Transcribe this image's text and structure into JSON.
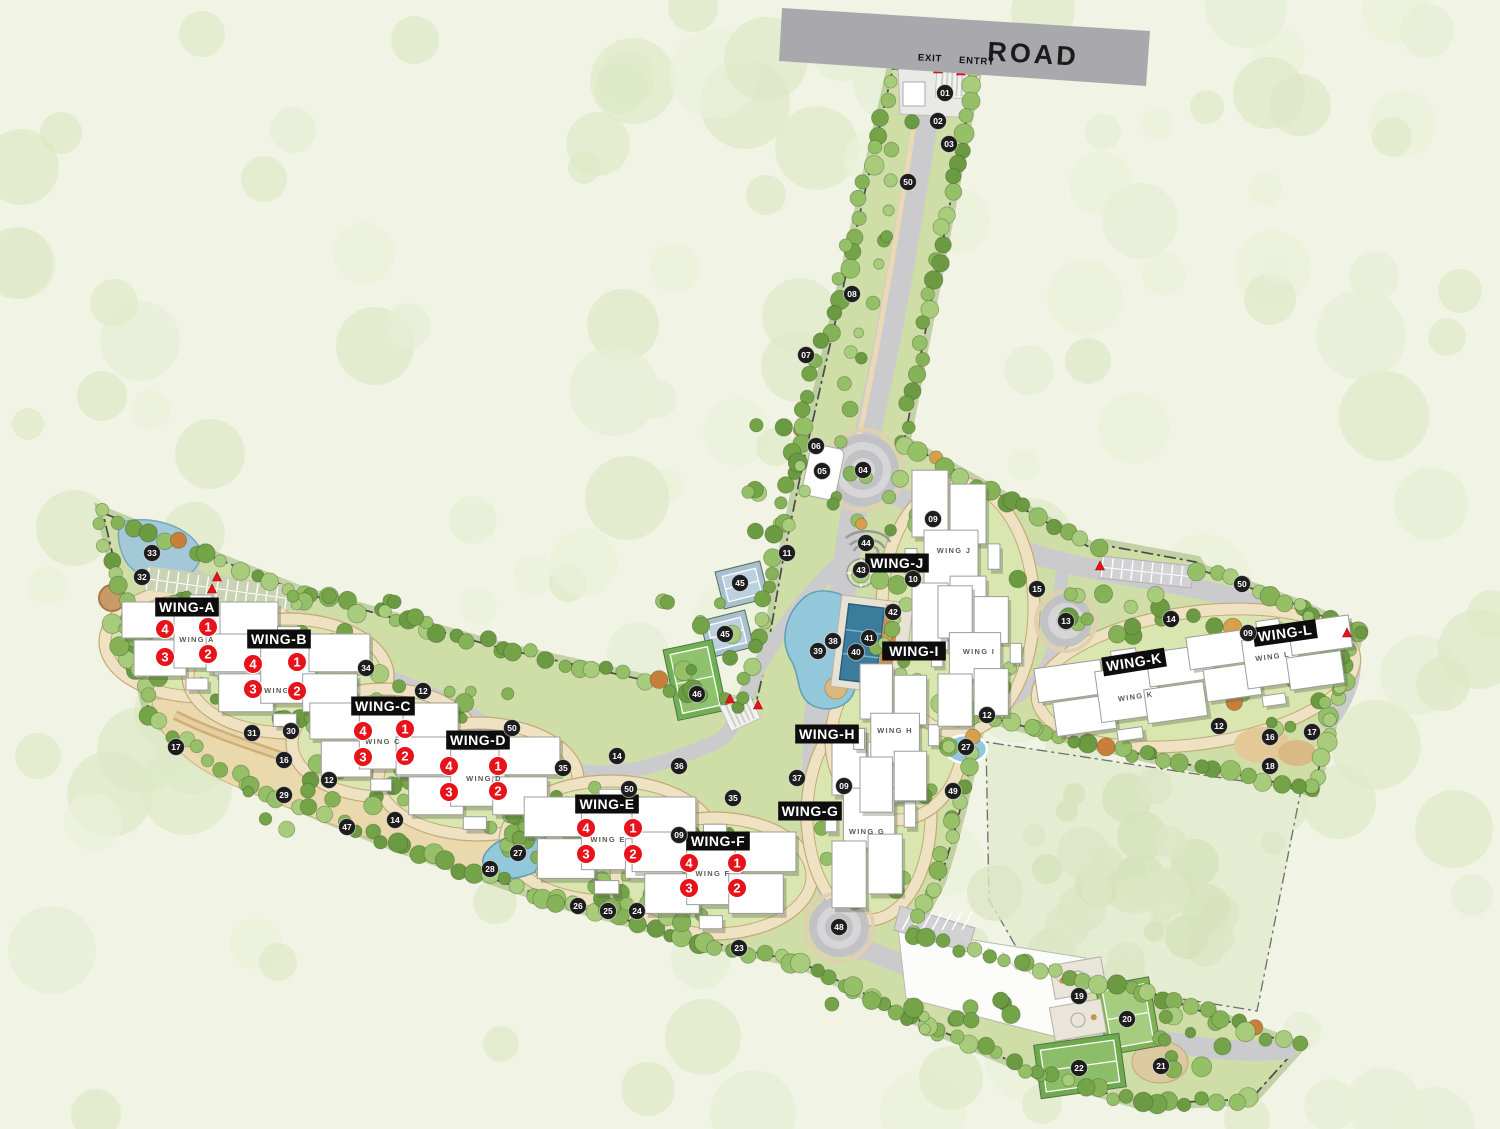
{
  "road": {
    "label": "ROAD",
    "exit": "EXIT",
    "entry": "ENTRY"
  },
  "colors": {
    "chip_bg": "#0d0d0d",
    "chip_text": "#ffffff",
    "unit_badge": "#e8121a",
    "marker_bg": "#1d1d1d",
    "road_banner": "#a9a9ad",
    "water": "#93c7da",
    "site_green": "#cfdda6"
  },
  "wings": [
    {
      "id": "A",
      "chip": "WING-A",
      "cx": 187,
      "cy": 607,
      "rot": 0,
      "bname": "WING A",
      "bx": 197,
      "by": 642,
      "brot": 0,
      "units": [
        {
          "n": "4",
          "x": 165,
          "y": 629
        },
        {
          "n": "1",
          "x": 208,
          "y": 627
        },
        {
          "n": "3",
          "x": 165,
          "y": 657
        },
        {
          "n": "2",
          "x": 208,
          "y": 654
        }
      ]
    },
    {
      "id": "B",
      "chip": "WING-B",
      "cx": 279,
      "cy": 639,
      "rot": 0,
      "bname": "WING B",
      "bx": 282,
      "by": 693,
      "brot": 0,
      "units": [
        {
          "n": "4",
          "x": 253,
          "y": 664
        },
        {
          "n": "1",
          "x": 297,
          "y": 662
        },
        {
          "n": "3",
          "x": 253,
          "y": 689
        },
        {
          "n": "2",
          "x": 297,
          "y": 691
        }
      ]
    },
    {
      "id": "C",
      "chip": "WING-C",
      "cx": 383,
      "cy": 706,
      "rot": 0,
      "bname": "WING C",
      "bx": 383,
      "by": 744,
      "brot": 0,
      "units": [
        {
          "n": "4",
          "x": 363,
          "y": 731
        },
        {
          "n": "1",
          "x": 405,
          "y": 729
        },
        {
          "n": "3",
          "x": 363,
          "y": 757
        },
        {
          "n": "2",
          "x": 405,
          "y": 756
        }
      ]
    },
    {
      "id": "D",
      "chip": "WING-D",
      "cx": 478,
      "cy": 740,
      "rot": 0,
      "bname": "WING D",
      "bx": 484,
      "by": 781,
      "brot": 0,
      "units": [
        {
          "n": "4",
          "x": 449,
          "y": 766
        },
        {
          "n": "1",
          "x": 498,
          "y": 766
        },
        {
          "n": "3",
          "x": 449,
          "y": 792
        },
        {
          "n": "2",
          "x": 498,
          "y": 791
        }
      ]
    },
    {
      "id": "E",
      "chip": "WING-E",
      "cx": 607,
      "cy": 804,
      "rot": 0,
      "bname": "WING E",
      "bx": 608,
      "by": 842,
      "brot": 0,
      "units": [
        {
          "n": "4",
          "x": 586,
          "y": 828
        },
        {
          "n": "1",
          "x": 633,
          "y": 828
        },
        {
          "n": "3",
          "x": 586,
          "y": 854
        },
        {
          "n": "2",
          "x": 633,
          "y": 854
        }
      ]
    },
    {
      "id": "F",
      "chip": "WING-F",
      "cx": 718,
      "cy": 841,
      "rot": 0,
      "bname": "WING F",
      "bx": 713,
      "by": 876,
      "brot": 0,
      "units": [
        {
          "n": "4",
          "x": 689,
          "y": 863
        },
        {
          "n": "1",
          "x": 737,
          "y": 863
        },
        {
          "n": "3",
          "x": 689,
          "y": 888
        },
        {
          "n": "2",
          "x": 737,
          "y": 888
        }
      ]
    },
    {
      "id": "G",
      "chip": "WING-G",
      "cx": 810,
      "cy": 811,
      "rot": 0,
      "bname": "WING G",
      "bx": 867,
      "by": 834,
      "brot": 0,
      "units": []
    },
    {
      "id": "H",
      "chip": "WING-H",
      "cx": 827,
      "cy": 734,
      "rot": 0,
      "bname": "WING H",
      "bx": 895,
      "by": 733,
      "brot": 0,
      "units": []
    },
    {
      "id": "I",
      "chip": "WING-I",
      "cx": 914,
      "cy": 651,
      "rot": 0,
      "bname": "WING I",
      "bx": 979,
      "by": 654,
      "brot": 0,
      "units": []
    },
    {
      "id": "J",
      "chip": "WING-J",
      "cx": 897,
      "cy": 563,
      "rot": 0,
      "bname": "WING J",
      "bx": 954,
      "by": 553,
      "brot": 0,
      "units": []
    },
    {
      "id": "K",
      "chip": "WING-K",
      "cx": 1134,
      "cy": 662,
      "rot": -9,
      "bname": "WING K",
      "bx": 1136,
      "by": 699,
      "brot": -8,
      "units": []
    },
    {
      "id": "L",
      "chip": "WING-L",
      "cx": 1285,
      "cy": 633,
      "rot": -8,
      "bname": "WING L",
      "bx": 1273,
      "by": 659,
      "brot": -8,
      "units": []
    }
  ],
  "markers": [
    {
      "n": "01",
      "x": 945,
      "y": 93
    },
    {
      "n": "02",
      "x": 938,
      "y": 121
    },
    {
      "n": "03",
      "x": 949,
      "y": 144
    },
    {
      "n": "50",
      "x": 908,
      "y": 182
    },
    {
      "n": "08",
      "x": 852,
      "y": 294
    },
    {
      "n": "07",
      "x": 806,
      "y": 355
    },
    {
      "n": "06",
      "x": 816,
      "y": 446
    },
    {
      "n": "05",
      "x": 822,
      "y": 471
    },
    {
      "n": "04",
      "x": 863,
      "y": 470
    },
    {
      "n": "11",
      "x": 787,
      "y": 553
    },
    {
      "n": "44",
      "x": 866,
      "y": 543
    },
    {
      "n": "43",
      "x": 861,
      "y": 570
    },
    {
      "n": "10",
      "x": 913,
      "y": 579
    },
    {
      "n": "09",
      "x": 933,
      "y": 519
    },
    {
      "n": "42",
      "x": 893,
      "y": 612
    },
    {
      "n": "41",
      "x": 869,
      "y": 638
    },
    {
      "n": "40",
      "x": 856,
      "y": 652
    },
    {
      "n": "38",
      "x": 833,
      "y": 641
    },
    {
      "n": "39",
      "x": 818,
      "y": 651
    },
    {
      "n": "45",
      "x": 740,
      "y": 583
    },
    {
      "n": "45",
      "x": 725,
      "y": 634
    },
    {
      "n": "46",
      "x": 697,
      "y": 694
    },
    {
      "n": "36",
      "x": 679,
      "y": 766
    },
    {
      "n": "35",
      "x": 733,
      "y": 798
    },
    {
      "n": "37",
      "x": 797,
      "y": 778
    },
    {
      "n": "09",
      "x": 844,
      "y": 786
    },
    {
      "n": "49",
      "x": 953,
      "y": 791
    },
    {
      "n": "27",
      "x": 966,
      "y": 747
    },
    {
      "n": "12",
      "x": 987,
      "y": 715
    },
    {
      "n": "48",
      "x": 839,
      "y": 927
    },
    {
      "n": "15",
      "x": 1037,
      "y": 589
    },
    {
      "n": "13",
      "x": 1066,
      "y": 621
    },
    {
      "n": "50",
      "x": 1242,
      "y": 584
    },
    {
      "n": "14",
      "x": 1171,
      "y": 619
    },
    {
      "n": "09",
      "x": 1248,
      "y": 633
    },
    {
      "n": "12",
      "x": 1219,
      "y": 726
    },
    {
      "n": "16",
      "x": 1270,
      "y": 737
    },
    {
      "n": "17",
      "x": 1312,
      "y": 732
    },
    {
      "n": "18",
      "x": 1270,
      "y": 766
    },
    {
      "n": "33",
      "x": 152,
      "y": 553
    },
    {
      "n": "32",
      "x": 142,
      "y": 577
    },
    {
      "n": "34",
      "x": 366,
      "y": 668
    },
    {
      "n": "12",
      "x": 423,
      "y": 691
    },
    {
      "n": "31",
      "x": 252,
      "y": 733
    },
    {
      "n": "30",
      "x": 291,
      "y": 731
    },
    {
      "n": "17",
      "x": 176,
      "y": 747
    },
    {
      "n": "16",
      "x": 284,
      "y": 760
    },
    {
      "n": "12",
      "x": 329,
      "y": 780
    },
    {
      "n": "29",
      "x": 284,
      "y": 795
    },
    {
      "n": "47",
      "x": 347,
      "y": 827
    },
    {
      "n": "14",
      "x": 395,
      "y": 820
    },
    {
      "n": "27",
      "x": 518,
      "y": 853
    },
    {
      "n": "28",
      "x": 490,
      "y": 869
    },
    {
      "n": "26",
      "x": 578,
      "y": 906
    },
    {
      "n": "25",
      "x": 608,
      "y": 911
    },
    {
      "n": "24",
      "x": 637,
      "y": 911
    },
    {
      "n": "23",
      "x": 739,
      "y": 948
    },
    {
      "n": "50",
      "x": 512,
      "y": 728
    },
    {
      "n": "14",
      "x": 617,
      "y": 756
    },
    {
      "n": "35",
      "x": 563,
      "y": 768
    },
    {
      "n": "50",
      "x": 629,
      "y": 789
    },
    {
      "n": "09",
      "x": 679,
      "y": 835
    },
    {
      "n": "19",
      "x": 1079,
      "y": 996
    },
    {
      "n": "20",
      "x": 1127,
      "y": 1019
    },
    {
      "n": "21",
      "x": 1161,
      "y": 1066
    },
    {
      "n": "22",
      "x": 1079,
      "y": 1068
    }
  ],
  "red_pins": [
    {
      "x": 938,
      "y": 70
    },
    {
      "x": 961,
      "y": 72
    },
    {
      "x": 217,
      "y": 578
    },
    {
      "x": 212,
      "y": 590
    },
    {
      "x": 730,
      "y": 700
    },
    {
      "x": 758,
      "y": 706
    },
    {
      "x": 1100,
      "y": 567
    },
    {
      "x": 1347,
      "y": 634
    }
  ]
}
